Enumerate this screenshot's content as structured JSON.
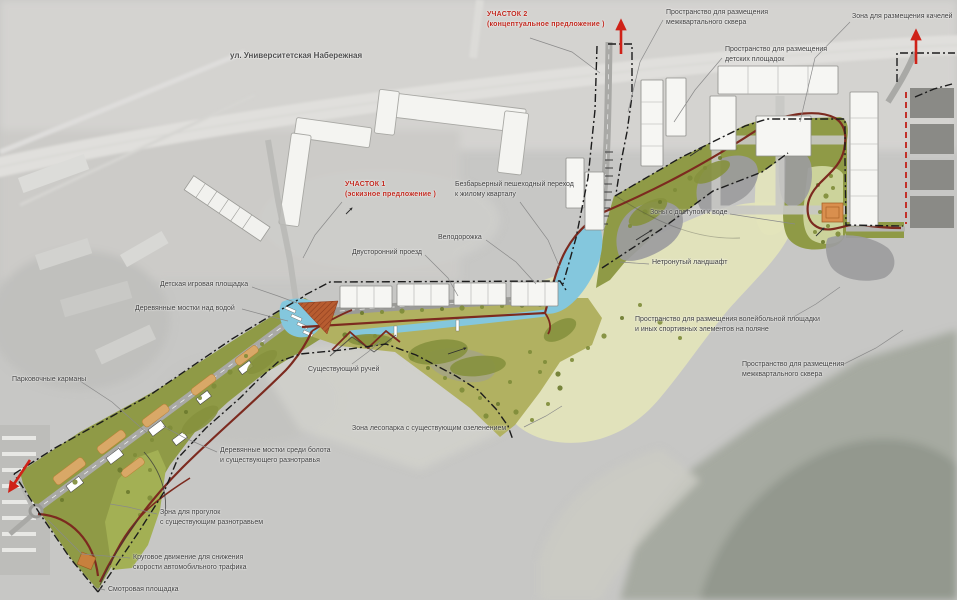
{
  "document": {
    "type": "landscape-masterplan",
    "language": "ru",
    "site_sections": [
      {
        "name": "УЧАСТОК 1",
        "status": "(эскизное предложение  )"
      },
      {
        "name": "УЧАСТОК 2",
        "status": "(концептуальное предложение  )"
      }
    ]
  },
  "palette": {
    "accent_red": "#c0281e",
    "path_red": "#7c2a1f",
    "water_blue": "#84c7dd",
    "olive_green": "#8f9a46",
    "meadow_green": "#b1b161",
    "pale_clearing": "#e3e4bb",
    "parking_orange": "#d9a867",
    "plaza_terracotta": "#b75c30",
    "boundary_black": "#1c1c1c",
    "photo_gray": "#c7c7c5"
  },
  "labels": [
    {
      "id": "street-name",
      "x": 230,
      "y": 50,
      "text": "ул. Университетская Набережная",
      "kind": "street",
      "leader": []
    },
    {
      "id": "section-2",
      "x": 487,
      "y": 10,
      "text": "УЧАСТОК 2\n(концептуальное предложение  )",
      "kind": "red",
      "leader": [
        [
          530,
          38
        ],
        [
          572,
          52
        ],
        [
          600,
          73
        ]
      ]
    },
    {
      "id": "interquarter-square-top",
      "x": 666,
      "y": 8,
      "text": "Пространство для размещения\nмежквартального сквера",
      "leader": [
        [
          663,
          20
        ],
        [
          640,
          62
        ],
        [
          628,
          112
        ]
      ]
    },
    {
      "id": "swings-zone",
      "x": 852,
      "y": 12,
      "text": "Зона для размещения качелей",
      "leader": [
        [
          850,
          22
        ],
        [
          815,
          58
        ],
        [
          800,
          122
        ]
      ]
    },
    {
      "id": "children-playgrounds",
      "x": 725,
      "y": 45,
      "text": "Пространство для размещения\nдетских площадок",
      "leader": [
        [
          722,
          58
        ],
        [
          695,
          90
        ],
        [
          674,
          122
        ]
      ]
    },
    {
      "id": "section-1",
      "x": 345,
      "y": 180,
      "text": "УЧАСТОК 1\n(эскизное предложение  )",
      "kind": "red",
      "leader": [
        [
          342,
          202
        ],
        [
          315,
          235
        ],
        [
          303,
          258
        ]
      ]
    },
    {
      "id": "barrier-free-crossing",
      "x": 455,
      "y": 180,
      "text": "Безбарьерный пешеходный переход\nк жилому кварталу",
      "leader": [
        [
          520,
          202
        ],
        [
          548,
          240
        ],
        [
          560,
          268
        ]
      ]
    },
    {
      "id": "bike-path",
      "x": 438,
      "y": 233,
      "text": "Велодорожка",
      "leader": [
        [
          486,
          240
        ],
        [
          516,
          262
        ],
        [
          536,
          284
        ]
      ]
    },
    {
      "id": "two-way-drive",
      "x": 352,
      "y": 248,
      "text": "Двусторонний проезд",
      "leader": [
        [
          425,
          255
        ],
        [
          448,
          278
        ],
        [
          458,
          296
        ]
      ]
    },
    {
      "id": "water-access-zones",
      "x": 650,
      "y": 208,
      "text": "Зоны с доступом к воде",
      "leader": [
        [
          730,
          214
        ],
        [
          762,
          219
        ],
        [
          795,
          224
        ]
      ]
    },
    {
      "id": "children-play-area",
      "x": 160,
      "y": 280,
      "text": "Детская игровая площадка",
      "leader": [
        [
          252,
          287
        ],
        [
          278,
          296
        ],
        [
          297,
          303
        ]
      ]
    },
    {
      "id": "wooden-decks-water",
      "x": 135,
      "y": 304,
      "text": "Деревянные мостки над водой",
      "leader": [
        [
          242,
          309
        ],
        [
          268,
          316
        ],
        [
          288,
          321
        ]
      ]
    },
    {
      "id": "untouched-landscape",
      "x": 652,
      "y": 258,
      "text": "Нетронутый ландшафт",
      "leader": [
        [
          649,
          264
        ],
        [
          634,
          263
        ],
        [
          620,
          262
        ]
      ]
    },
    {
      "id": "volleyball-space",
      "x": 635,
      "y": 315,
      "text": "Пространство для размещения волейбольной площадки\nи иных спортивных элементов на поляне",
      "leader": [
        [
          790,
          319
        ],
        [
          816,
          304
        ],
        [
          840,
          287
        ]
      ]
    },
    {
      "id": "interquarter-square-right",
      "x": 742,
      "y": 360,
      "text": "Пространство для размещения\nмежквартального сквера",
      "leader": [
        [
          842,
          365
        ],
        [
          876,
          348
        ],
        [
          903,
          330
        ]
      ]
    },
    {
      "id": "existing-stream",
      "x": 308,
      "y": 365,
      "text": "Существующий ручей",
      "leader": [
        [
          352,
          364
        ],
        [
          368,
          352
        ],
        [
          380,
          342
        ]
      ]
    },
    {
      "id": "parking-pockets",
      "x": 12,
      "y": 375,
      "text": "Парковочные карманы",
      "leader": [
        [
          80,
          381
        ],
        [
          112,
          402
        ],
        [
          148,
          434
        ]
      ]
    },
    {
      "id": "forest-park-zone",
      "x": 352,
      "y": 424,
      "text": "Зона лесопарка с существующим озеленением",
      "leader": [
        [
          524,
          427
        ],
        [
          546,
          416
        ],
        [
          562,
          406
        ]
      ]
    },
    {
      "id": "bog-decks",
      "x": 220,
      "y": 446,
      "text": "Деревянные мостки среди болота\nи существующего разнотравья",
      "leader": [
        [
          217,
          452
        ],
        [
          185,
          438
        ],
        [
          163,
          426
        ]
      ]
    },
    {
      "id": "walking-zone",
      "x": 160,
      "y": 508,
      "text": "Зона для прогулок\nс существующим разнотравьем",
      "leader": [
        [
          157,
          514
        ],
        [
          128,
          507
        ],
        [
          110,
          504
        ]
      ]
    },
    {
      "id": "roundabout",
      "x": 133,
      "y": 553,
      "text": "Круговое движение для снижения\nскорости автомобильного трафика",
      "leader": [
        [
          130,
          558
        ],
        [
          82,
          554
        ],
        [
          48,
          520
        ]
      ]
    },
    {
      "id": "viewpoint",
      "x": 108,
      "y": 585,
      "text": "Смотровая площадка",
      "leader": [
        [
          105,
          590
        ],
        [
          96,
          588
        ]
      ]
    }
  ],
  "annotations": {
    "red_arrows": "entry/exit direction arrows",
    "dash_dot_line": "design area boundary"
  }
}
